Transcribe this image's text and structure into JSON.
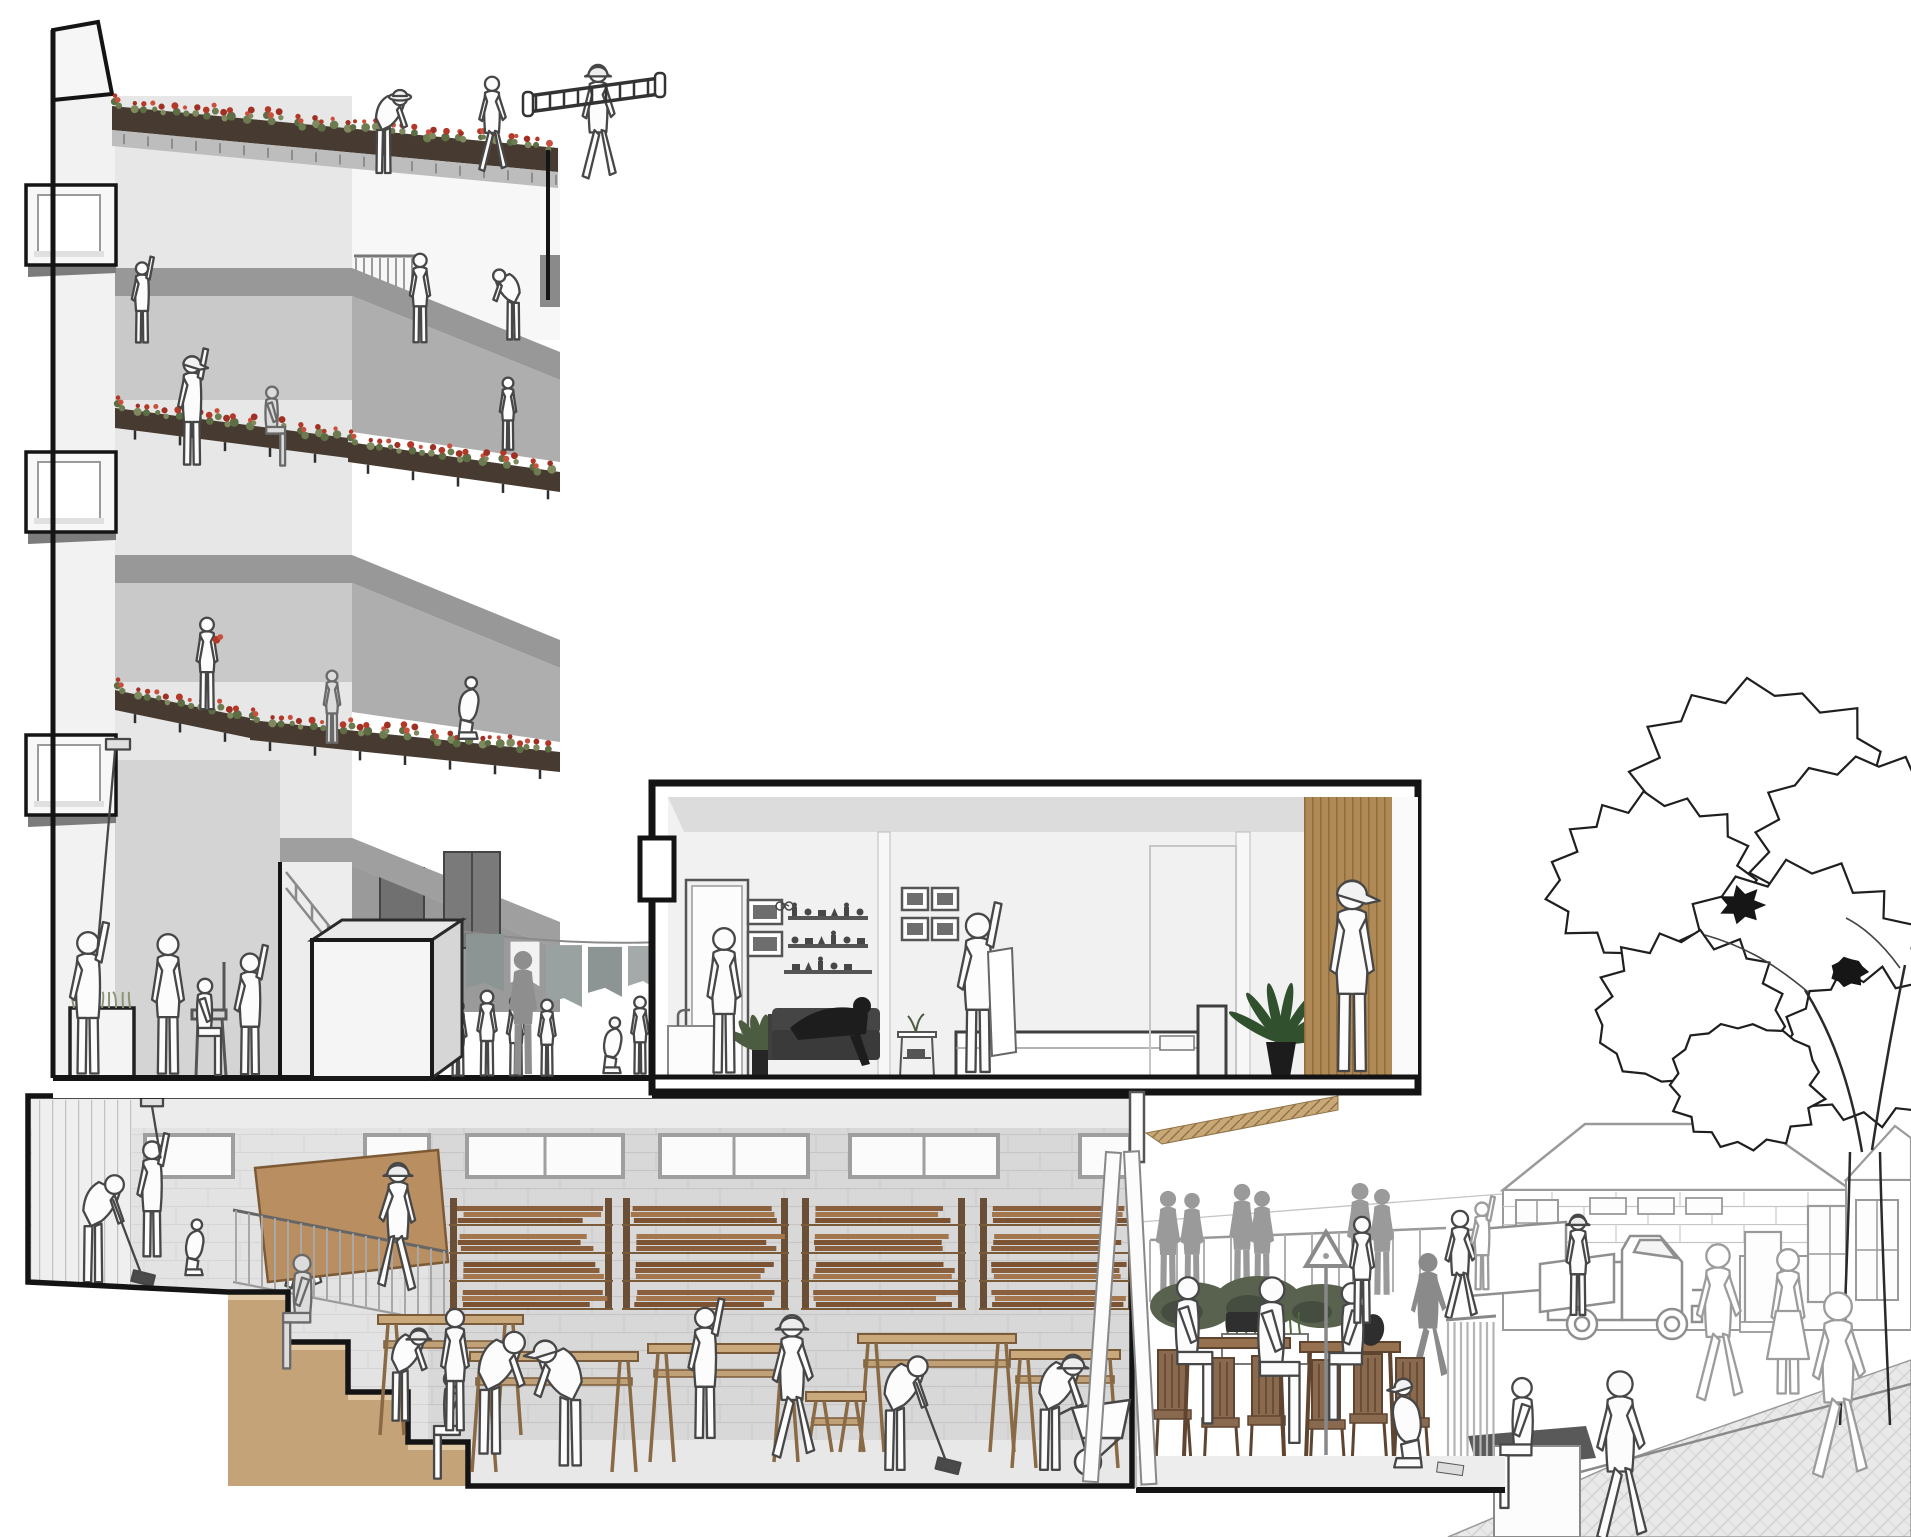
{
  "meta": {
    "kind": "architectural-section-perspective-illustration",
    "width": 1911,
    "height": 1537
  },
  "palette": {
    "outline": "#141414",
    "line_stroke": "#474747",
    "faint_stroke": "#9c9c9c",
    "wall_light": "#f2f2f2",
    "wall_stucco": "#e7e7e7",
    "slab_gray": "#989898",
    "interior_gray": "#c9c9c9",
    "recess_gray": "#aeaeae",
    "block_wall": "#d8d8d8",
    "planter_dark": "#473a31",
    "flower_red": "#b23828",
    "flower_red2": "#c9503c",
    "leaf_green": "#5d6e45",
    "plant_green": "#31502e",
    "wood_plank": "#8a5f3e",
    "wood_plank2": "#a3764e",
    "wood_plank3": "#7c5434",
    "bench_wood": "#c9a87c",
    "step_tan": "#c5a379",
    "tread_tan": "#e2cba6",
    "panel_wood": "#b08a56",
    "table_wood": "#96714f",
    "chair_wood": "#8a6a4f",
    "soffit_wood": "#c8a876",
    "silhouette_gray": "#9a9a9a",
    "sofa_dark": "#3a3a3a",
    "hedge_green": "#59624f",
    "board_brown": "#b98e60"
  },
  "left_building": {
    "window_box_ys": [
      185,
      452,
      735
    ],
    "flower_strips": [
      {
        "x1": 112,
        "y1": 96,
        "x2": 558,
        "y2": 138,
        "ph": 24,
        "roof": true
      },
      {
        "x1": 115,
        "y1": 398,
        "x2": 348,
        "y2": 428,
        "ph": 20
      },
      {
        "x1": 348,
        "y1": 432,
        "x2": 560,
        "y2": 462,
        "ph": 20
      },
      {
        "x1": 115,
        "y1": 680,
        "x2": 250,
        "y2": 708,
        "ph": 20
      },
      {
        "x1": 250,
        "y1": 710,
        "x2": 560,
        "y2": 742,
        "ph": 20
      }
    ]
  },
  "courtyard": {
    "laundry_line": {
      "x1": 418,
      "y1": 924,
      "x2": 700,
      "y2": 940
    },
    "laundry": [
      {
        "x": 428,
        "w": 34,
        "h": 52,
        "c": "#98a0a0"
      },
      {
        "x": 466,
        "w": 38,
        "h": 58,
        "c": "#8d9494"
      },
      {
        "x": 510,
        "w": 30,
        "h": 46,
        "c": "#f2f2f2"
      },
      {
        "x": 546,
        "w": 36,
        "h": 62,
        "c": "#9aa1a1"
      },
      {
        "x": 588,
        "w": 34,
        "h": 50,
        "c": "#8d9494"
      },
      {
        "x": 628,
        "w": 30,
        "h": 44,
        "c": "#a4aaaa"
      },
      {
        "x": 664,
        "w": 26,
        "h": 40,
        "c": "#98a0a0"
      }
    ]
  },
  "workshop": {
    "clerestory": [
      {
        "x": 143,
        "w": 92
      },
      {
        "x": 363,
        "w": 68
      },
      {
        "x": 465,
        "w": 160
      },
      {
        "x": 658,
        "w": 152
      },
      {
        "x": 848,
        "w": 152
      },
      {
        "x": 1078,
        "w": 54
      }
    ],
    "racks": [
      {
        "x": 455,
        "w": 152
      },
      {
        "x": 628,
        "w": 155
      },
      {
        "x": 807,
        "w": 153
      },
      {
        "x": 985,
        "w": 145
      }
    ],
    "benches": [
      {
        "x": 378,
        "y": 1315,
        "w": 145,
        "base": 1435
      },
      {
        "x": 470,
        "y": 1352,
        "w": 168,
        "base": 1472
      },
      {
        "x": 648,
        "y": 1344,
        "w": 152,
        "base": 1462
      },
      {
        "x": 858,
        "y": 1334,
        "w": 158,
        "base": 1452
      },
      {
        "x": 1010,
        "y": 1350,
        "w": 110,
        "base": 1468
      },
      {
        "x": 806,
        "y": 1392,
        "w": 60,
        "base": 1452
      }
    ]
  },
  "terrace": {
    "tables": [
      {
        "x": 1178,
        "y": 1338,
        "w": 112
      },
      {
        "x": 1300,
        "y": 1342,
        "w": 100
      }
    ],
    "chairs": [
      {
        "x": 1158,
        "base": 1462
      },
      {
        "x": 1206,
        "base": 1470
      },
      {
        "x": 1252,
        "base": 1468
      },
      {
        "x": 1312,
        "base": 1472
      },
      {
        "x": 1354,
        "base": 1466
      },
      {
        "x": 1396,
        "base": 1470
      }
    ],
    "hedge": [
      {
        "x": 1192,
        "y": 1306,
        "rx": 42,
        "ry": 24
      },
      {
        "x": 1258,
        "y": 1302,
        "rx": 44,
        "ry": 26
      },
      {
        "x": 1322,
        "y": 1306,
        "rx": 40,
        "ry": 22
      }
    ]
  },
  "street": {
    "tree_blobs": [
      [
        1762,
        795,
        118
      ],
      [
        1655,
        880,
        92
      ],
      [
        1868,
        852,
        105
      ],
      [
        1800,
        968,
        112
      ],
      [
        1690,
        1010,
        85
      ],
      [
        1872,
        1048,
        82
      ],
      [
        1745,
        1085,
        70
      ]
    ],
    "dark_clusters": [
      [
        1742,
        905,
        18
      ],
      [
        1848,
        972,
        16
      ]
    ]
  },
  "figures": {
    "roof": [
      {
        "name": "roof-gardener",
        "x": 385,
        "y": 176,
        "h": 100,
        "pose": "bend",
        "style": "line",
        "hat": "round"
      },
      {
        "name": "roof-walker",
        "x": 492,
        "y": 174,
        "h": 98,
        "pose": "walk",
        "style": "line"
      },
      {
        "name": "roof-ladder-carrier",
        "x": 598,
        "y": 182,
        "h": 118,
        "pose": "walk",
        "style": "line",
        "hat": "hard"
      }
    ],
    "upper": [
      {
        "name": "l4-left-painter",
        "x": 142,
        "y": 345,
        "h": 85,
        "pose": "reach",
        "style": "line"
      },
      {
        "name": "l4-window-person",
        "x": 420,
        "y": 345,
        "h": 92,
        "pose": "stand",
        "style": "line",
        "flip": true
      },
      {
        "name": "l4-planter-builder",
        "x": 512,
        "y": 342,
        "h": 85,
        "pose": "bend",
        "style": "line",
        "flip": true
      },
      {
        "name": "l3-painter",
        "x": 192,
        "y": 468,
        "h": 115,
        "pose": "reach",
        "style": "line",
        "hat": "cap"
      },
      {
        "name": "l3-seated",
        "x": 272,
        "y": 468,
        "h": 82,
        "pose": "sit",
        "style": "shade"
      },
      {
        "name": "l3-child",
        "x": 508,
        "y": 452,
        "h": 75,
        "pose": "stand",
        "style": "line",
        "flip": true
      },
      {
        "name": "l2-flower-woman",
        "x": 207,
        "y": 712,
        "h": 95,
        "pose": "stand",
        "style": "line",
        "prop": "flowers"
      },
      {
        "name": "l2-elder",
        "x": 332,
        "y": 745,
        "h": 75,
        "pose": "stand",
        "style": "shade"
      },
      {
        "name": "l2-kneeler",
        "x": 468,
        "y": 742,
        "h": 80,
        "pose": "crouch",
        "style": "line"
      }
    ],
    "ground": [
      {
        "name": "ground-roller-painter",
        "x": 88,
        "y": 1078,
        "h": 150,
        "pose": "reach",
        "style": "line",
        "prop": "longpole"
      },
      {
        "name": "ground-barber",
        "x": 168,
        "y": 1078,
        "h": 145,
        "pose": "stand",
        "style": "line"
      },
      {
        "name": "ground-client",
        "x": 205,
        "y": 1078,
        "h": 100,
        "pose": "sit",
        "style": "line"
      },
      {
        "name": "ground-assistant",
        "x": 250,
        "y": 1078,
        "h": 128,
        "pose": "reach",
        "style": "line"
      },
      {
        "name": "courtyard-elder",
        "x": 396,
        "y": 1012,
        "h": 78,
        "pose": "bend",
        "style": "line",
        "flip": true
      },
      {
        "name": "courtyard-kid-1",
        "x": 458,
        "y": 1078,
        "h": 78,
        "pose": "stand",
        "style": "line"
      },
      {
        "name": "courtyard-kid-2",
        "x": 487,
        "y": 1078,
        "h": 88,
        "pose": "stand",
        "style": "line",
        "flip": true
      },
      {
        "name": "courtyard-kid-3",
        "x": 516,
        "y": 1078,
        "h": 83,
        "pose": "stand",
        "style": "line"
      },
      {
        "name": "courtyard-adult-silhouette",
        "x": 523,
        "y": 1078,
        "h": 128,
        "pose": "stand",
        "style": "silh",
        "color": "#8e8e8e"
      },
      {
        "name": "courtyard-kid-4",
        "x": 547,
        "y": 1078,
        "h": 79,
        "pose": "stand",
        "style": "line",
        "flip": true
      },
      {
        "name": "courtyard-croucher",
        "x": 612,
        "y": 1076,
        "h": 72,
        "pose": "crouch",
        "style": "line"
      },
      {
        "name": "courtyard-kid-5",
        "x": 640,
        "y": 1076,
        "h": 80,
        "pose": "stand",
        "style": "line",
        "flip": true
      }
    ],
    "apartment": [
      {
        "name": "apt-kitchen-person",
        "x": 724,
        "y": 1077,
        "h": 150,
        "pose": "stand",
        "style": "line",
        "flip": true
      },
      {
        "name": "apt-laundry-folder",
        "x": 978,
        "y": 1077,
        "h": 168,
        "pose": "reach",
        "style": "line"
      },
      {
        "name": "apt-hall-man",
        "x": 1352,
        "y": 1077,
        "h": 198,
        "pose": "stand",
        "style": "line",
        "hat": "cap"
      }
    ],
    "workshopA": [
      {
        "name": "ws-sweeper-1",
        "x": 95,
        "y": 1286,
        "h": 130,
        "pose": "bend",
        "style": "line",
        "prop": "broom"
      },
      {
        "name": "ws-roller-painter",
        "x": 152,
        "y": 1260,
        "h": 122,
        "pose": "reach",
        "style": "line",
        "prop": "roller"
      },
      {
        "name": "ws-child",
        "x": 194,
        "y": 1278,
        "h": 72,
        "pose": "crouch",
        "style": "line"
      },
      {
        "name": "ws-carrier-1",
        "x": 302,
        "y": 1292,
        "h": 128,
        "pose": "walk",
        "style": "line"
      }
    ],
    "workshopB": [
      {
        "name": "ws-carrier-2",
        "x": 398,
        "y": 1294,
        "h": 132,
        "pose": "walk",
        "style": "line",
        "hat": "hard",
        "flip": true
      },
      {
        "name": "ws-step-sitter-1",
        "x": 302,
        "y": 1372,
        "h": 118,
        "pose": "sit",
        "style": "shade",
        "flip": true
      },
      {
        "name": "ws-step-sitter-2",
        "x": 452,
        "y": 1482,
        "h": 112,
        "pose": "sit",
        "style": "line",
        "flip": true
      },
      {
        "name": "ws-bench-worker-1",
        "x": 402,
        "y": 1424,
        "h": 112,
        "pose": "bend",
        "style": "line",
        "hat": "hard"
      },
      {
        "name": "ws-bench-worker-2",
        "x": 455,
        "y": 1434,
        "h": 126,
        "pose": "stand",
        "style": "line"
      },
      {
        "name": "ws-hooded-worker",
        "x": 492,
        "y": 1458,
        "h": 148,
        "pose": "bend",
        "style": "line"
      },
      {
        "name": "ws-cap-woman",
        "x": 568,
        "y": 1470,
        "h": 152,
        "pose": "bend",
        "style": "line",
        "hat": "cap",
        "flip": true
      },
      {
        "name": "ws-reacher",
        "x": 705,
        "y": 1442,
        "h": 138,
        "pose": "reach",
        "style": "line"
      },
      {
        "name": "ws-walker",
        "x": 792,
        "y": 1462,
        "h": 148,
        "pose": "walk",
        "style": "line",
        "hat": "hard"
      },
      {
        "name": "ws-sweeper-2",
        "x": 897,
        "y": 1474,
        "h": 138,
        "pose": "bend",
        "style": "line",
        "prop": "broom"
      },
      {
        "name": "ws-barrow-worker",
        "x": 1052,
        "y": 1474,
        "h": 140,
        "pose": "bend",
        "style": "line",
        "hat": "hard"
      }
    ],
    "terrace": [
      {
        "name": "terrace-silhouette-1",
        "x": 1168,
        "y": 1302,
        "h": 112,
        "pose": "stand",
        "style": "silh"
      },
      {
        "name": "terrace-silhouette-2",
        "x": 1192,
        "y": 1300,
        "h": 108,
        "pose": "stand",
        "style": "silh"
      },
      {
        "name": "terrace-silhouette-3",
        "x": 1242,
        "y": 1298,
        "h": 115,
        "pose": "stand",
        "style": "silh"
      },
      {
        "name": "terrace-silhouette-4",
        "x": 1262,
        "y": 1300,
        "h": 110,
        "pose": "stand",
        "style": "silh"
      },
      {
        "name": "terrace-silhouette-5",
        "x": 1360,
        "y": 1300,
        "h": 118,
        "pose": "stand",
        "style": "silh"
      },
      {
        "name": "terrace-silhouette-6",
        "x": 1382,
        "y": 1298,
        "h": 110,
        "pose": "stand",
        "style": "silh"
      },
      {
        "name": "terrace-sitter-left",
        "x": 1188,
        "y": 1428,
        "h": 152,
        "pose": "sit",
        "style": "line"
      },
      {
        "name": "terrace-woman-center",
        "x": 1272,
        "y": 1448,
        "h": 172,
        "pose": "sit",
        "style": "line"
      },
      {
        "name": "terrace-sitter-right",
        "x": 1352,
        "y": 1424,
        "h": 142,
        "pose": "sit",
        "style": "line",
        "flip": true
      },
      {
        "name": "terrace-stander",
        "x": 1362,
        "y": 1326,
        "h": 110,
        "pose": "stand",
        "style": "line"
      },
      {
        "name": "terrace-silhouette-runner",
        "x": 1428,
        "y": 1384,
        "h": 132,
        "pose": "walk",
        "style": "silh",
        "color": "#8a8a8a"
      },
      {
        "name": "terrace-croucher",
        "x": 1408,
        "y": 1472,
        "h": 115,
        "pose": "crouch",
        "style": "line",
        "hat": "cap",
        "flip": true
      }
    ],
    "street": [
      {
        "name": "street-mover-1",
        "x": 1460,
        "y": 1322,
        "h": 112,
        "pose": "walk",
        "style": "line"
      },
      {
        "name": "street-mover-2",
        "x": 1578,
        "y": 1318,
        "h": 104,
        "pose": "stand",
        "style": "line",
        "hat": "hard"
      },
      {
        "name": "street-reacher",
        "x": 1482,
        "y": 1292,
        "h": 92,
        "pose": "reach",
        "style": "faint"
      },
      {
        "name": "street-walker-1",
        "x": 1718,
        "y": 1405,
        "h": 162,
        "pose": "walk",
        "style": "faint"
      },
      {
        "name": "street-dress-woman",
        "x": 1788,
        "y": 1398,
        "h": 150,
        "pose": "stand",
        "style": "faint",
        "skirt": true
      },
      {
        "name": "street-walker-away",
        "x": 1838,
        "y": 1483,
        "h": 192,
        "pose": "walk",
        "style": "faint"
      },
      {
        "name": "street-front-walker",
        "x": 1620,
        "y": 1545,
        "h": 175,
        "pose": "walk",
        "style": "line"
      },
      {
        "name": "street-ledge-sitter",
        "x": 1522,
        "y": 1512,
        "h": 135,
        "pose": "sit",
        "style": "line",
        "flip": true
      }
    ]
  }
}
